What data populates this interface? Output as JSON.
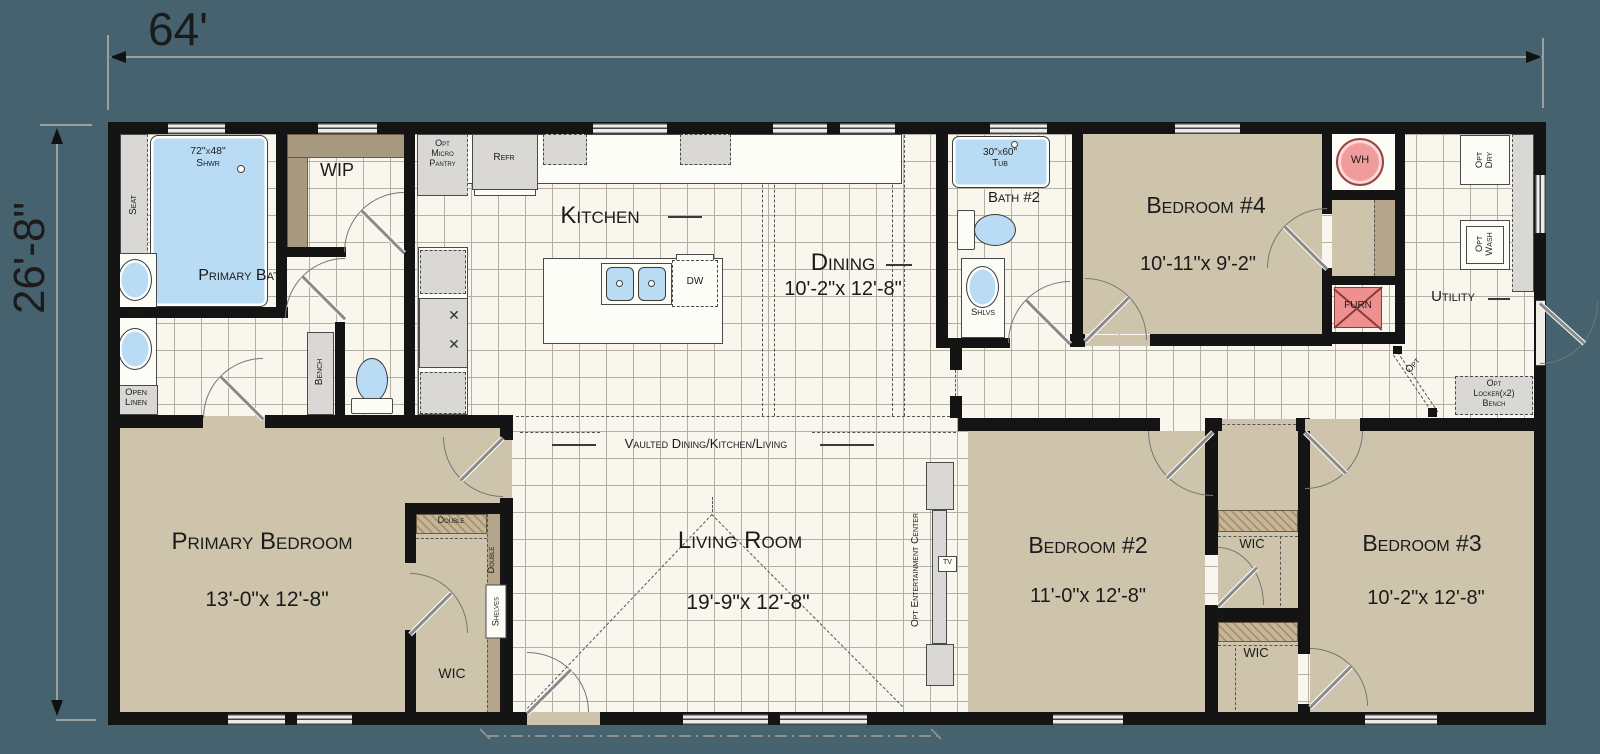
{
  "dim": {
    "width": "64'",
    "height": "26'-8\""
  },
  "rooms": {
    "kitchen": {
      "name": "Kitchen"
    },
    "dining": {
      "name": "Dining",
      "size": "10'-2\"x 12'-8\""
    },
    "living": {
      "name": "Living Room",
      "size": "19'-9\"x 12'-8\""
    },
    "primary_bedroom": {
      "name": "Primary Bedroom",
      "size": "13'-0\"x 12'-8\""
    },
    "bedroom2": {
      "name": "Bedroom #2",
      "size": "11'-0\"x 12'-8\""
    },
    "bedroom3": {
      "name": "Bedroom #3",
      "size": "10'-2\"x 12'-8\""
    },
    "bedroom4": {
      "name": "Bedroom #4",
      "size": "10'-11\"x 9'-2\""
    },
    "primary_bath": {
      "name": "Primary Bath"
    },
    "bath2": {
      "name": "Bath #2"
    },
    "utility": {
      "name": "Utility"
    },
    "wip": {
      "name": "WIP"
    },
    "vaulted_note": "Vaulted Dining/Kitchen/Living"
  },
  "closets": {
    "wic": "WIC",
    "double": "Double",
    "shelves": "Shelves"
  },
  "fixtures": {
    "shower": "72\"x48\"\nShwr",
    "tub": "30\"x60\"\nTub",
    "seat": "Seat",
    "bench": "Bench",
    "ds": "DS",
    "open_linen": "Open\nLinen",
    "refr": "Refr",
    "dw": "DW",
    "opt_micro_pantry": "Opt\nMicro\nPantry",
    "wh": "WH",
    "furn": "FURN",
    "shlvs": "Shlvs",
    "opt_dry": "Opt\nDry",
    "opt_wash": "Opt\nWash",
    "opt_locker": "Opt\nLocker(x2)\nBench",
    "opt": "Opt",
    "opt_entertainment": "Opt Entertainment Center",
    "tv": "TV",
    "burners": "✕\n✕"
  },
  "colors": {
    "wall": "#141414",
    "floor": "#f9f6ee",
    "room_fill": "#cdc4ab",
    "counter": "#a89a7e",
    "fixture_blue": "#b9dcf4",
    "equipment_pink": "#f09c9c",
    "background": "#45626e"
  }
}
